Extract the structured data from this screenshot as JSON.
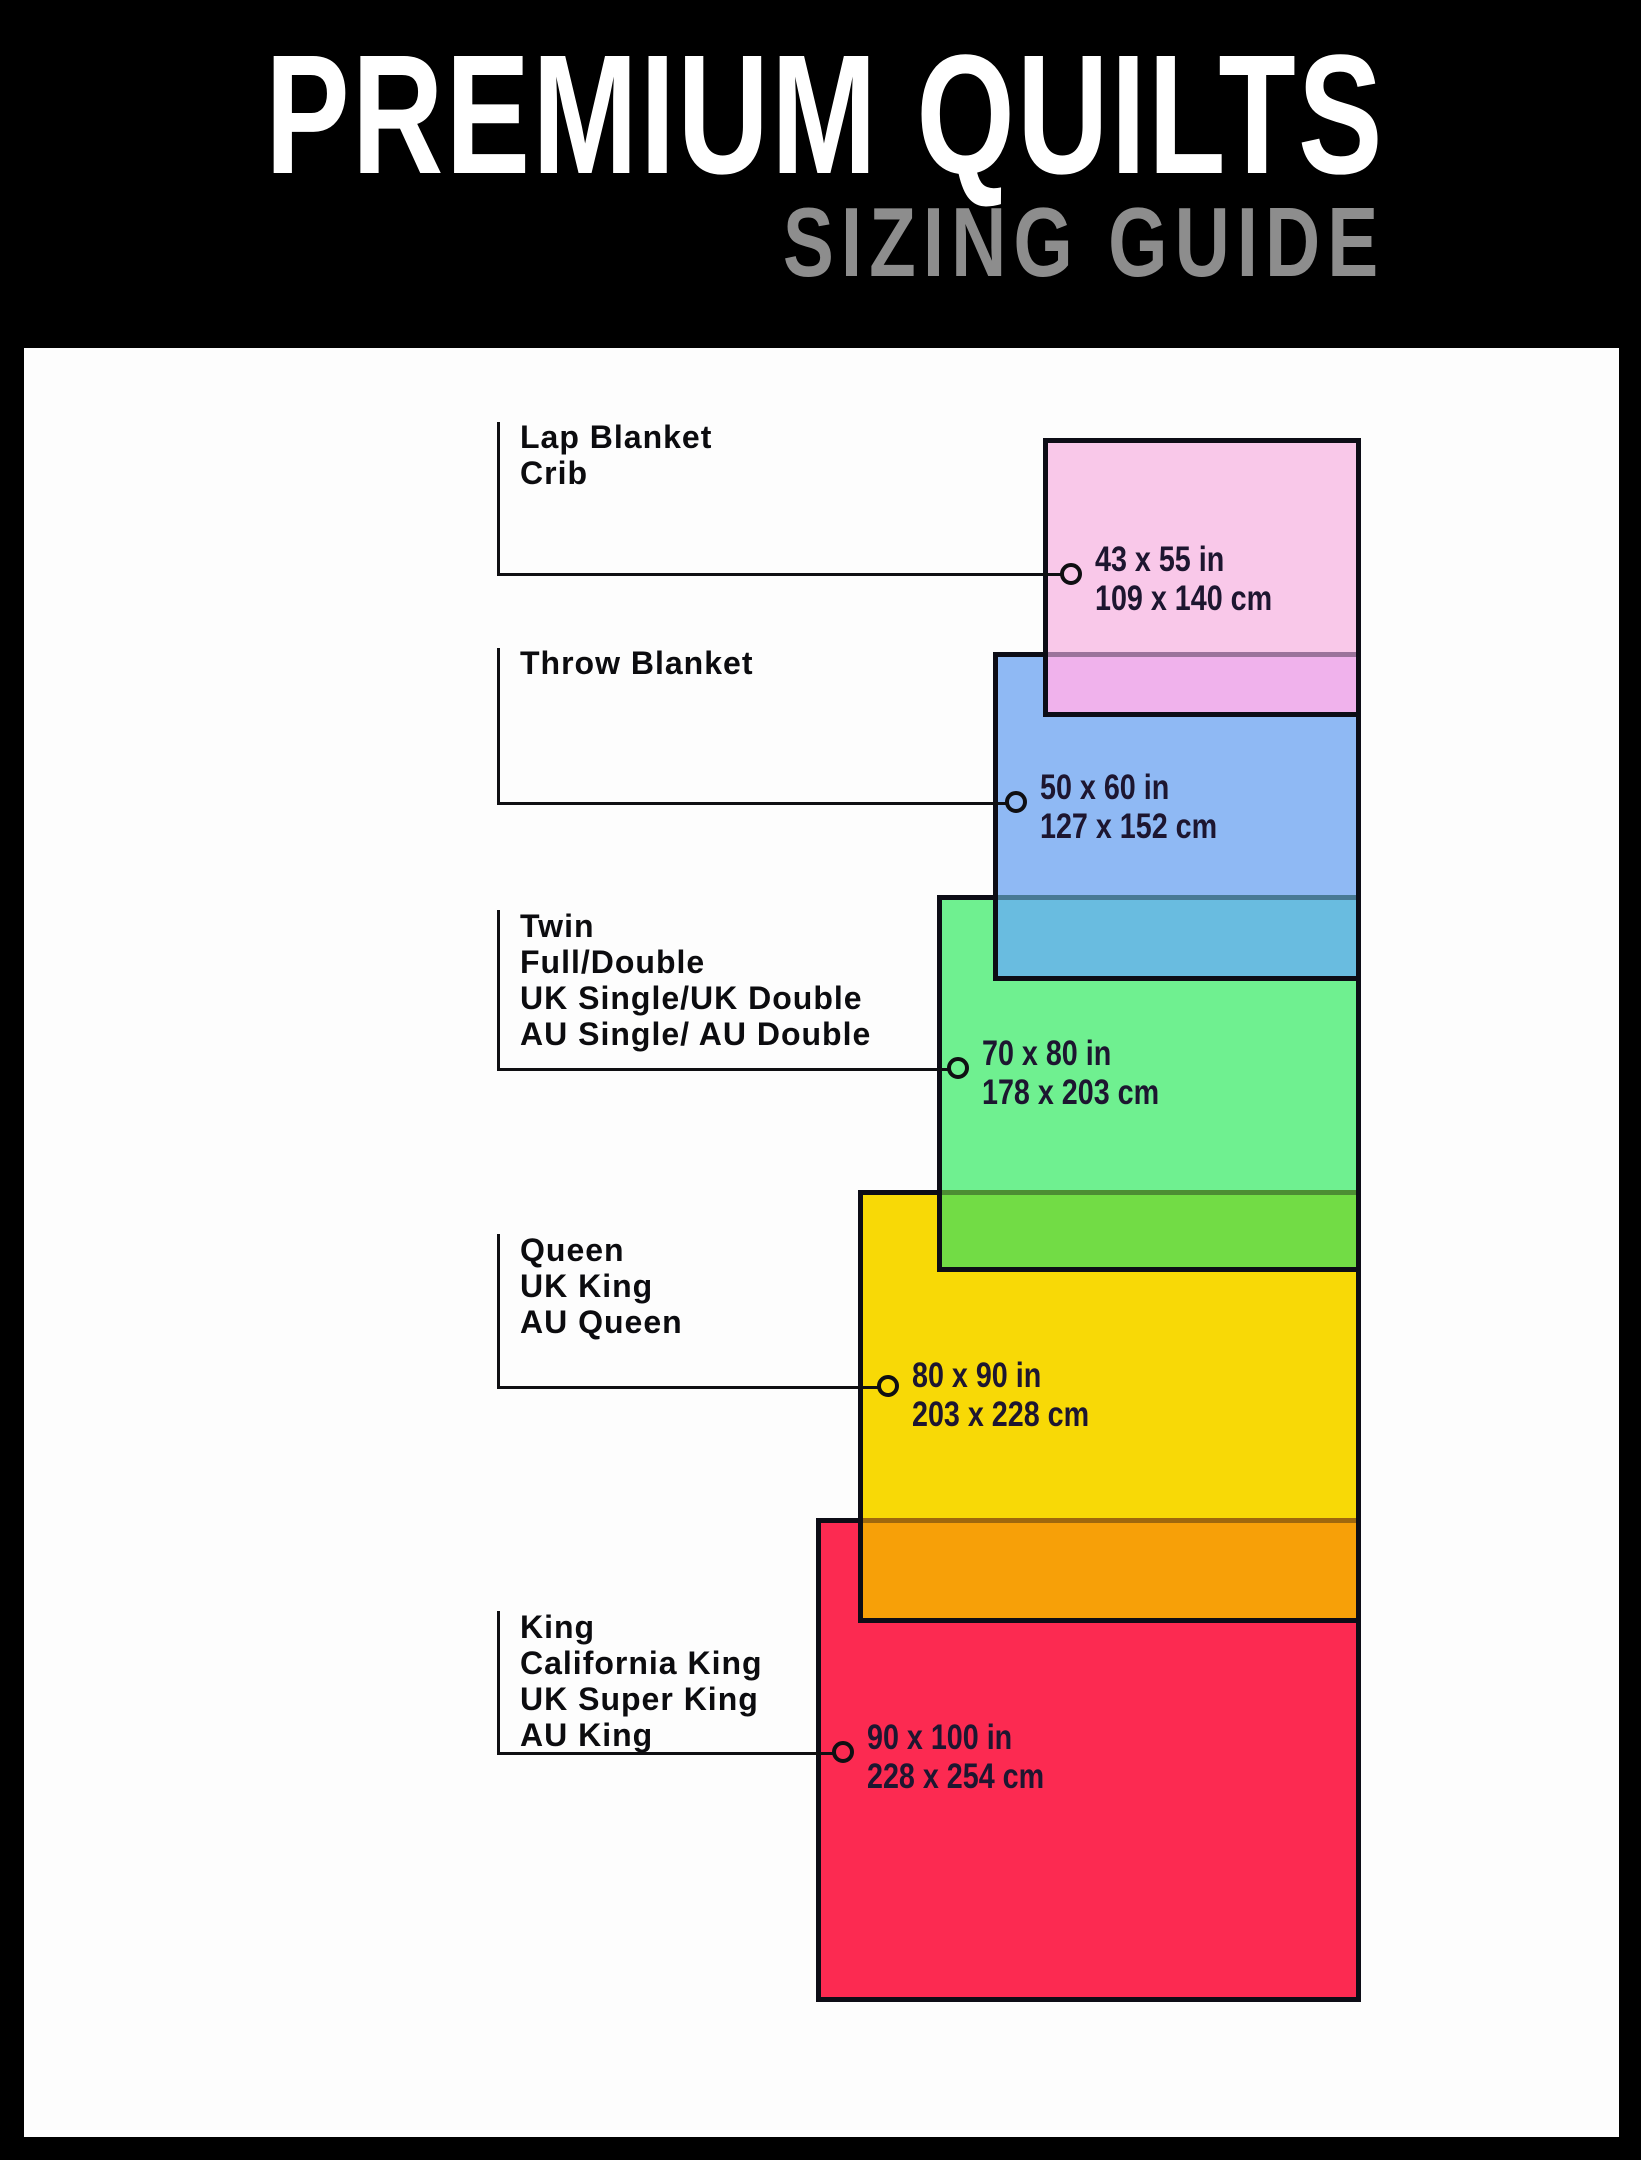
{
  "header": {
    "title": "PREMIUM QUILTS",
    "subtitle": "SIZING GUIDE"
  },
  "sizes": [
    {
      "id": "lap",
      "labels": [
        "Lap Blanket",
        "Crib"
      ],
      "inches": "43 x 55 in",
      "cm": "109 x 140 cm",
      "fill": "#F9C8E9"
    },
    {
      "id": "throw",
      "labels": [
        "Throw Blanket"
      ],
      "inches": "50 x 60 in",
      "cm": "127 x 152 cm",
      "fill": "#8FB9F4"
    },
    {
      "id": "twin",
      "labels": [
        "Twin",
        "Full/Double",
        "UK Single/UK Double",
        "AU Single/ AU Double"
      ],
      "inches": "70 x 80 in",
      "cm": "178 x 203 cm",
      "fill": "#6FF090"
    },
    {
      "id": "queen",
      "labels": [
        "Queen",
        "UK King",
        "AU Queen"
      ],
      "inches": "80 x 90 in",
      "cm": "203 x 228 cm",
      "fill": "#F8D906"
    },
    {
      "id": "king",
      "labels": [
        "King",
        "California King",
        "UK Super King",
        "AU King"
      ],
      "inches": "90 x 100 in",
      "cm": "228 x 254 cm",
      "fill": "#FC2A51"
    }
  ],
  "overlaps": [
    {
      "over": "lap",
      "under": "throw",
      "color": "#F0B2EC"
    },
    {
      "over": "throw",
      "under": "twin",
      "color": "#69BCE0"
    },
    {
      "over": "twin",
      "under": "queen",
      "color": "#72DC45"
    },
    {
      "over": "queen",
      "under": "king",
      "color": "#F7A008"
    }
  ],
  "palette": {
    "background": "#000000",
    "board": "#FDFDFD",
    "title_color": "#FFFFFF",
    "subtitle_color": "#8D8D8D",
    "rect_border": "#0D0D16",
    "line_color": "#0F0F12",
    "label_text": "#0C0C0F",
    "dim_text": "#1D1630"
  }
}
